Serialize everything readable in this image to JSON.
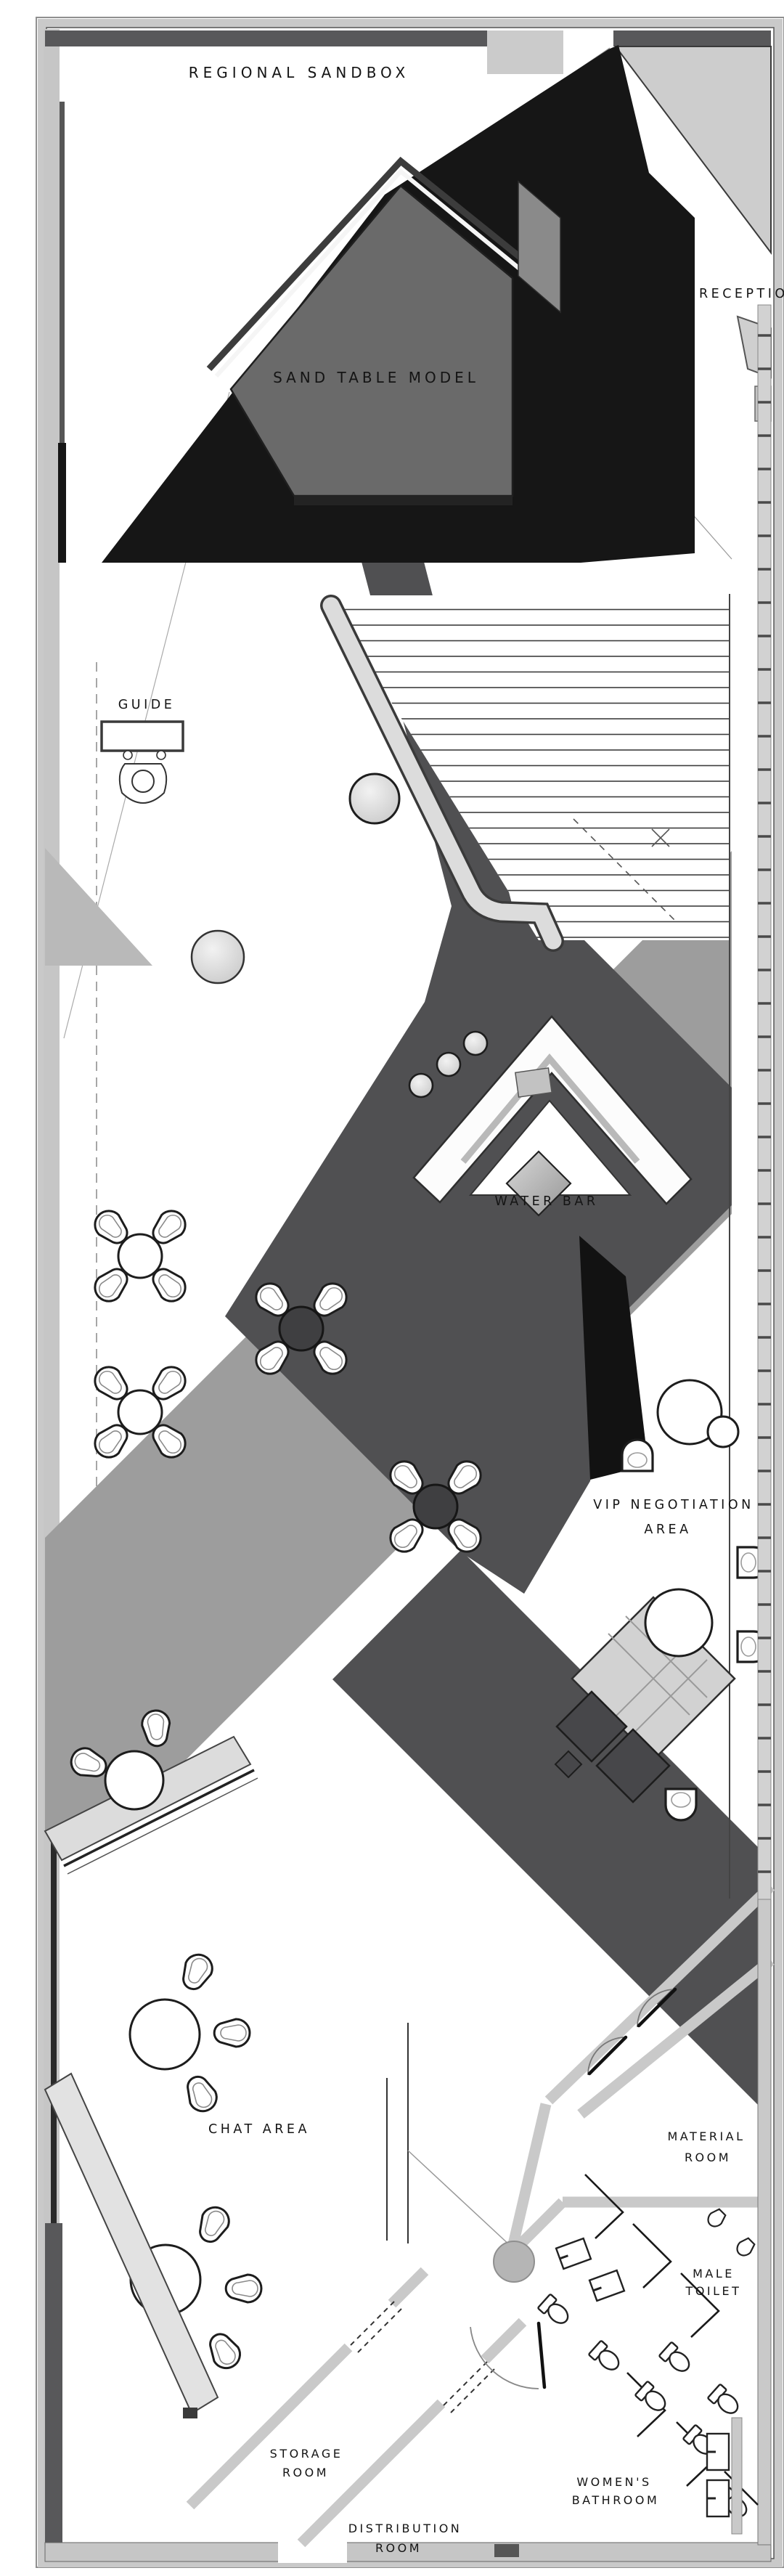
{
  "title": "Sales center floor plan",
  "rooms": [
    {
      "id": "regional-sandbox",
      "label": "REGIONAL SANDBOX",
      "lines": [
        "REGIONAL SANDBOX"
      ]
    },
    {
      "id": "sand-table-model",
      "label": "SAND TABLE MODEL",
      "lines": [
        "SAND TABLE MODEL"
      ]
    },
    {
      "id": "reception",
      "label": "RECEPTION",
      "lines": [
        "RECEPTION"
      ]
    },
    {
      "id": "guide",
      "label": "GUIDE",
      "lines": [
        "GUIDE"
      ]
    },
    {
      "id": "water-bar",
      "label": "WATER BAR",
      "lines": [
        "WATER BAR"
      ]
    },
    {
      "id": "vip-negotiation-area",
      "label": "VIP NEGOTIATION AREA",
      "lines": [
        "VIP NEGOTIATION",
        "AREA"
      ]
    },
    {
      "id": "chat-area",
      "label": "CHAT AREA",
      "lines": [
        "CHAT AREA"
      ]
    },
    {
      "id": "material-room",
      "label": "MATERIAL ROOM",
      "lines": [
        "MATERIAL",
        "ROOM"
      ]
    },
    {
      "id": "male-toilet",
      "label": "MALE TOILET",
      "lines": [
        "MALE",
        "TOILET"
      ]
    },
    {
      "id": "storage-room",
      "label": "STORAGE ROOM",
      "lines": [
        "STORAGE",
        "ROOM"
      ]
    },
    {
      "id": "womens-bathroom",
      "label": "WOMEN'S BATHROOM",
      "lines": [
        "WOMEN'S",
        "BATHROOM"
      ]
    },
    {
      "id": "distribution-room",
      "label": "DISTRIBUTION ROOM",
      "lines": [
        "DISTRIBUTION",
        "ROOM"
      ]
    }
  ],
  "palette": {
    "paper": "#ffffff",
    "text": "#141414",
    "black": "#161616",
    "dark": "#505052",
    "sand": "#6a6a6a",
    "gray": "#9d9d9d",
    "light": "#cdcdcd",
    "wall": "#c6c6c6",
    "line": "#2a2a2a"
  }
}
